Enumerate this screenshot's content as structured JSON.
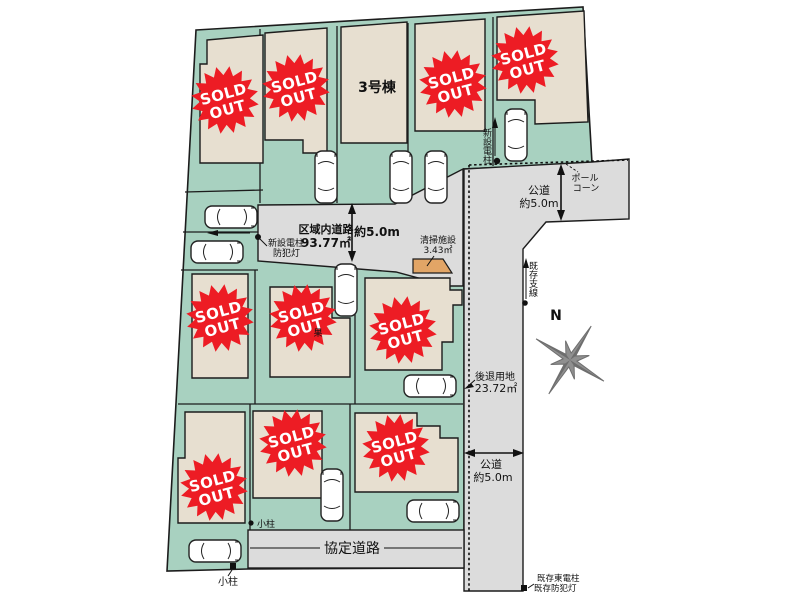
{
  "badge": {
    "sold": "SOLD",
    "out": "OUT"
  },
  "lots": {
    "building3_label": "3号棟"
  },
  "annotations": {
    "district_road": {
      "name": "区域内道路",
      "area": "93.77㎡",
      "width": "約5.0m"
    },
    "new_pole_left": {
      "line1": "新設電柱",
      "line2": "防犯灯"
    },
    "cleaning_facility": {
      "line1": "清掃施設",
      "line2": "3.43㎡"
    },
    "public_road_top": {
      "line1": "公道",
      "line2": "約5.0m"
    },
    "pole_cone": {
      "line1": "ポール",
      "line2": "コーン"
    },
    "new_pole_right": {
      "label": "新設電柱"
    },
    "existing_support": {
      "label": "既存支線"
    },
    "setback": {
      "line1": "後退用地",
      "line2": "23.72㎡"
    },
    "compass": {
      "label": "N"
    },
    "public_road_right": {
      "line1": "公道",
      "line2": "約5.0m"
    },
    "agreement_road": {
      "label": "協定道路"
    },
    "small_post_top": {
      "label": "小柱"
    },
    "small_post_bottom": {
      "label": "小柱"
    },
    "existing_pole_bottom": {
      "line1": "既存東電柱",
      "line2": "既存防犯灯"
    },
    "lot7_marker": {
      "label": "果"
    }
  },
  "colors": {
    "site_green": "#a8d1c0",
    "building_beige": "#e7dfd0",
    "road_gray": "#dcdcdc",
    "facility_orange": "#e2a566",
    "badge_red": "#ed1c24",
    "outline": "#1c1c1c",
    "compass_gray": "#8f8f8f"
  }
}
